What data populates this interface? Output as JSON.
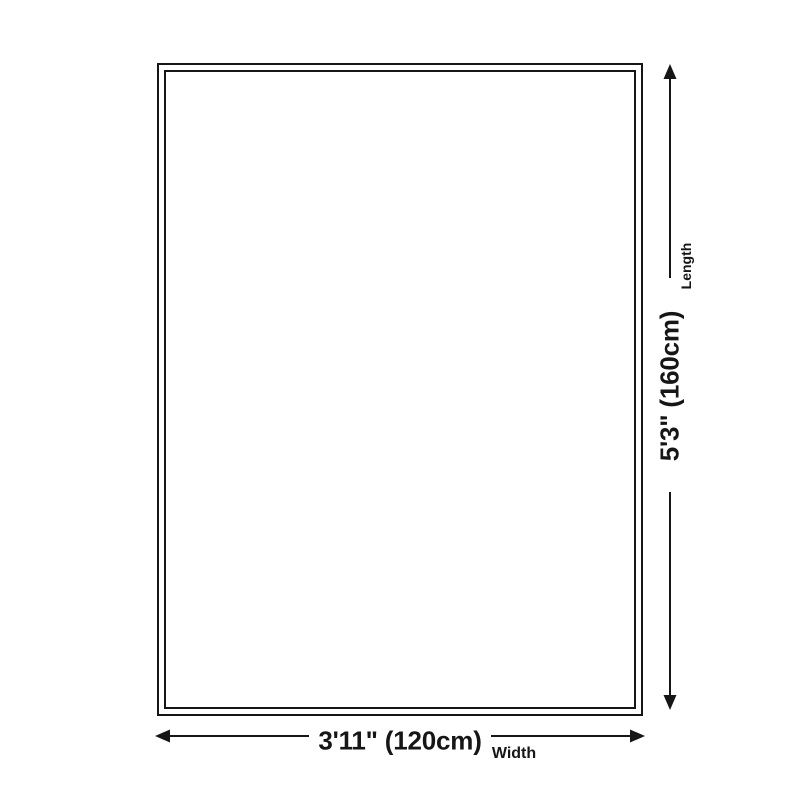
{
  "diagram": {
    "type": "product-dimension-diagram",
    "dimensions": {
      "width": {
        "value": "3'11\" (120cm)",
        "label": "Width"
      },
      "length": {
        "value": "5'3\" (160cm)",
        "label": "Length"
      }
    },
    "colors": {
      "ink": "#161616",
      "background": "#ffffff"
    }
  }
}
